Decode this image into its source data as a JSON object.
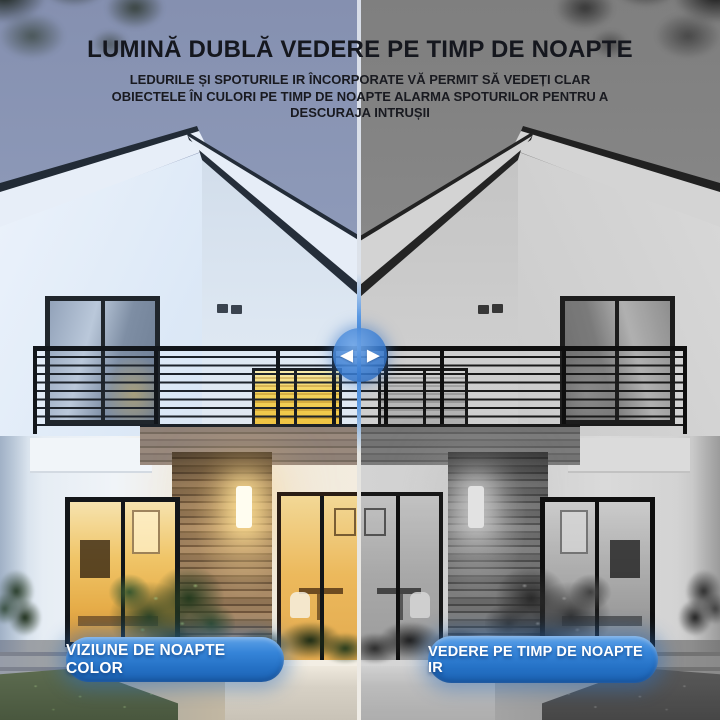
{
  "header": {
    "title": "LUMINĂ DUBLĂ VEDERE PE TIMP DE NOAPTE",
    "subtitle_lines": [
      "LEDURILE ȘI SPOTURILE IR ÎNCORPORATE VĂ PERMIT SĂ VEDEȚI CLAR",
      "OBIECTELE ÎN CULORI PE TIMP DE NOAPTE ALARMA SPOTURILOR PENTRU A",
      "DESCURAJA INTRUȘII"
    ]
  },
  "panels": {
    "left": {
      "label": "VIZIUNE DE NOAPTE COLOR"
    },
    "right": {
      "label": "VEDERE PE TIMP DE NOAPTE IR"
    }
  },
  "slider": {
    "left_arrow": "◀",
    "right_arrow": "▶"
  },
  "colors": {
    "accent_blue": "#2f7ed2",
    "title_text": "#15171e",
    "button_text": "#ffffff",
    "sky_left": "#8b97b6",
    "sky_right": "#77787a",
    "window_glow": "#f0c863"
  }
}
